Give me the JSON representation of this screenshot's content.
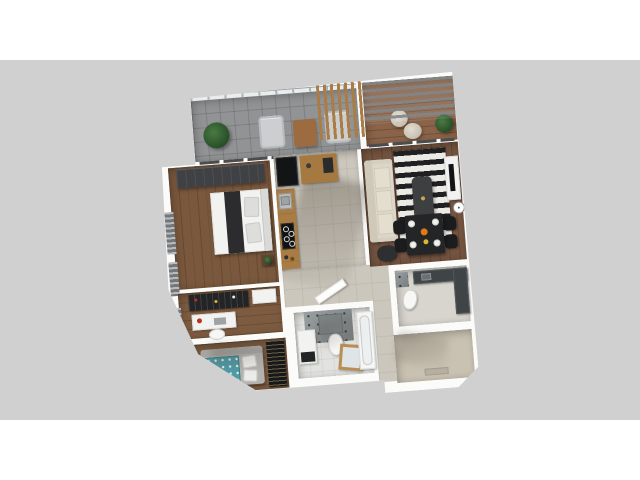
{
  "scene": {
    "type": "3d-floor-plan-render",
    "description": "Top-down 3D render of a two-bedroom apartment, slightly rotated, centered on a gray letterboxed canvas",
    "canvas": {
      "page_bg": "#ffffff",
      "band_bg": "#d0d0d0",
      "band_top_px": 60,
      "band_height_px": 360
    },
    "plan_rotation_deg": -4.5
  },
  "palette": {
    "wall": "#fbfbfa",
    "tile_balcony": "#919394",
    "deck_wood": "#8a6348",
    "wood_bedroom": "#7a583d",
    "wood_living": "#745440",
    "floor_kitchen_hall": "#ccc7bd",
    "floor_bath": "#e2e2df",
    "floor_wc": "#d8d5ce",
    "floor_entry": "#c9c2b2",
    "rug_dark": "#202022",
    "rug_light": "#eceae5",
    "sofa": "#dcd6c8",
    "coffee_table": "#3e3f41",
    "dining_table": "#232527",
    "chair_black": "#1b1c1e",
    "bed_linen": "#f2f2f0",
    "bed_runner": "#2c2c2e",
    "headboard": "#d9d9d7",
    "wardrobe_dark": "#3f4144",
    "sideboard_dark": "#232426",
    "slat_cabinet": "#17181a",
    "kids_teal": "#4f9aa4",
    "kids_frame": "#b5b3b0",
    "counter_wood": "#a87c42",
    "appliance_black": "#131416",
    "steel": "#b9bcbd",
    "accent_dot_tile": "#8d9294",
    "pergola_wood": "#ab7d46",
    "pergola_gray": "#83878a",
    "plant_green": "#2f5c33",
    "tub_white": "#f6f6f4",
    "wc_counter": "#3f4447",
    "mirror_frame_wood": "#b98e54",
    "food_orange": "#e07818",
    "food_yellow": "#d8b830",
    "kettle_red": "#c03020"
  },
  "rooms": [
    {
      "name": "balcony-lounge",
      "floor": "gray-tile",
      "furniture": [
        "glass-railing",
        "potted-plant",
        "lounge-chair",
        "wood-side-table",
        "lounge-chair",
        "wood-slat-pergola-screen"
      ]
    },
    {
      "name": "terrace",
      "floor": "wood-deck",
      "furniture": [
        "pergola-slat-roof",
        "bean-bag-pouf",
        "bean-bag-pouf",
        "potted-plant"
      ]
    },
    {
      "name": "master-bedroom",
      "floor": "wood-plank",
      "furniture": [
        "sliding-wardrobe",
        "double-bed",
        "bed-runner",
        "pillows",
        "nightstand",
        "window-radiator",
        "window-radiator"
      ]
    },
    {
      "name": "kitchen",
      "floor": "light-tile",
      "furniture": [
        "tall-fridge-unit",
        "wood-cabinet",
        "coffee-machine",
        "wood-counter",
        "steel-sink",
        "cooktop-4-burners"
      ]
    },
    {
      "name": "living-room",
      "floor": "wood-plank",
      "furniture": [
        "fabric-sofa",
        "striped-rug",
        "coffee-table",
        "tv-cabinet",
        "tv",
        "wall-clock",
        "armchair",
        "dining-table",
        "dining-chair",
        "dining-chair",
        "dining-chair",
        "dining-chair",
        "table-setting-plates"
      ]
    },
    {
      "name": "dressing-area",
      "floor": "wood-plank",
      "furniture": [
        "dark-sideboard",
        "white-appliance-box",
        "vanity-desk",
        "washbasin"
      ]
    },
    {
      "name": "kids-bedroom",
      "floor": "wood-plank",
      "furniture": [
        "day-bed",
        "teal-patterned-duvet",
        "pillows",
        "slatted-wardrobe",
        "window-radiator"
      ]
    },
    {
      "name": "bathroom",
      "floor": "light-tile",
      "furniture": [
        "dotted-accent-wall",
        "shower-panel",
        "toilet",
        "vanity-unit",
        "framed-mirror",
        "bathtub",
        "open-door"
      ]
    },
    {
      "name": "wc-utility",
      "floor": "light-tile",
      "furniture": [
        "dotted-accent-wall",
        "toilet",
        "dark-counter",
        "counter-basin"
      ]
    },
    {
      "name": "entrance-hall",
      "floor": "beige-screed",
      "furniture": [
        "door-mat"
      ]
    },
    {
      "name": "hallway",
      "floor": "beige-screed",
      "furniture": []
    }
  ]
}
